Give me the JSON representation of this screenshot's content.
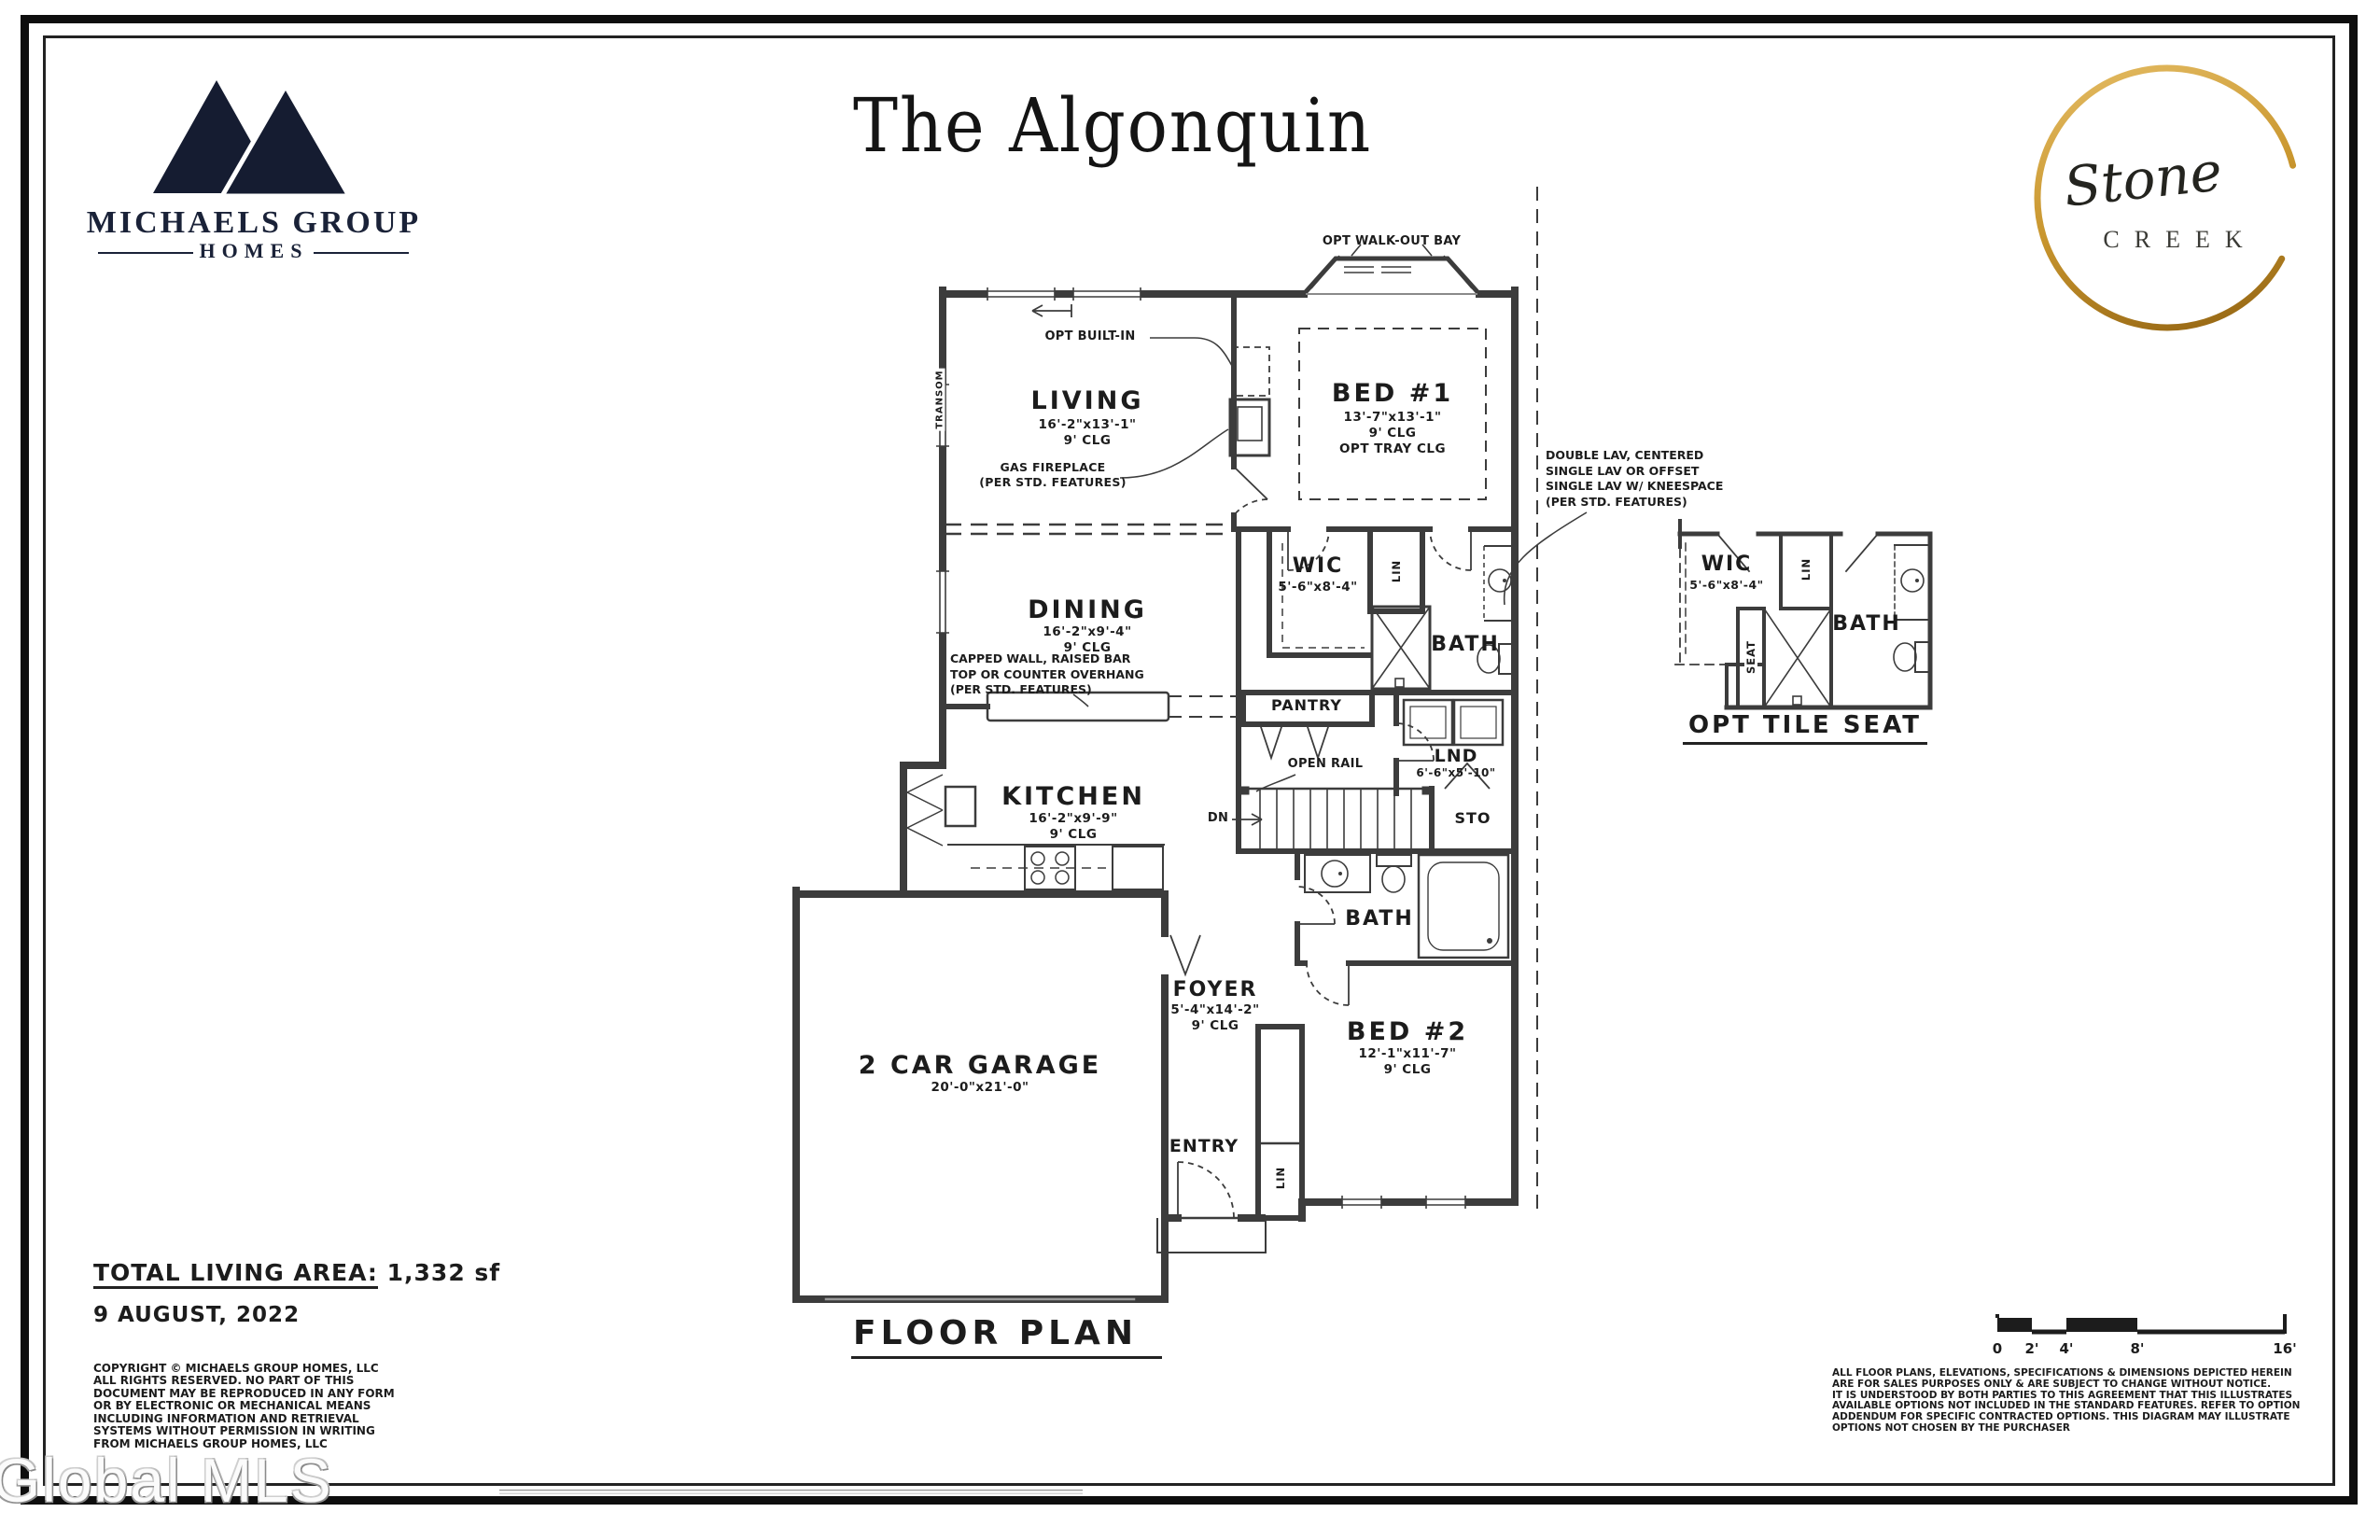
{
  "header": {
    "builder_logo": {
      "line1": "MICHAELS GROUP",
      "line2": "HOMES"
    },
    "plan_title": "The Algonquin",
    "community_logo": {
      "script": "Stone",
      "caps": "CREEK"
    }
  },
  "plan": {
    "rooms": {
      "living": {
        "name": "LIVING",
        "dims": "16'-2\"x13'-1\"",
        "clg": "9' CLG"
      },
      "bed1": {
        "name": "BED #1",
        "dims": "13'-7\"x13'-1\"",
        "clg": "9' CLG",
        "opt": "OPT TRAY CLG"
      },
      "dining": {
        "name": "DINING",
        "dims": "16'-2\"x9'-4\"",
        "clg": "9' CLG"
      },
      "kitchen": {
        "name": "KITCHEN",
        "dims": "16'-2\"x9'-9\"",
        "clg": "9' CLG"
      },
      "garage": {
        "name": "2 CAR GARAGE",
        "dims": "20'-0\"x21'-0\""
      },
      "foyer": {
        "name": "FOYER",
        "dims": "5'-4\"x14'-2\"",
        "clg": "9' CLG"
      },
      "bed2": {
        "name": "BED #2",
        "dims": "12'-1\"x11'-7\"",
        "clg": "9' CLG"
      },
      "wic": {
        "name": "WIC",
        "dims": "5'-6\"x8'-4\""
      },
      "bath1": {
        "name": "BATH"
      },
      "bath2": {
        "name": "BATH"
      },
      "laundry": {
        "name": "LND",
        "dims": "6'-6\"x5'-10\""
      },
      "pantry": {
        "name": "PANTRY"
      },
      "storage": {
        "name": "STO"
      },
      "entry": {
        "name": "ENTRY"
      },
      "linen1": "LIN",
      "linen2": "LIN",
      "down": "DN"
    },
    "notes": {
      "walkout_bay": "OPT WALK-OUT BAY",
      "built_in": "OPT BUILT-IN",
      "transom": "TRANSOM",
      "fireplace": [
        "GAS FIREPLACE",
        "(PER STD. FEATURES)"
      ],
      "capped_wall": [
        "CAPPED WALL, RAISED BAR",
        "TOP OR COUNTER OVERHANG",
        "(PER STD. FEATURES)"
      ],
      "double_lav": [
        "DOUBLE LAV, CENTERED",
        "SINGLE LAV OR OFFSET",
        "SINGLE LAV W/ KNEESPACE",
        "(PER STD. FEATURES)"
      ],
      "open_rail": "OPEN RAIL"
    },
    "detail": {
      "wic": {
        "name": "WIC",
        "dims": "5'-6\"x8'-4\""
      },
      "linen": "LIN",
      "seat": "SEAT",
      "bath": "BATH",
      "caption": "OPT TILE SEAT"
    }
  },
  "footer": {
    "area_label": "TOTAL LIVING AREA:",
    "area_value": "1,332 sf",
    "date": "9 AUGUST, 2022",
    "drawing_label": "FLOOR PLAN",
    "copyright": [
      "COPYRIGHT © MICHAELS GROUP HOMES, LLC",
      "ALL RIGHTS RESERVED. NO PART OF THIS",
      "DOCUMENT MAY BE REPRODUCED IN ANY FORM",
      "OR BY ELECTRONIC OR MECHANICAL MEANS",
      "INCLUDING INFORMATION AND RETRIEVAL",
      "SYSTEMS WITHOUT PERMISSION IN WRITING",
      "FROM MICHAELS GROUP HOMES, LLC"
    ],
    "disclaimer": [
      "ALL FLOOR PLANS, ELEVATIONS, SPECIFICATIONS & DIMENSIONS DEPICTED HEREIN",
      "ARE FOR SALES PURPOSES ONLY & ARE SUBJECT TO CHANGE WITHOUT NOTICE.",
      "IT IS UNDERSTOOD BY BOTH PARTIES TO THIS AGREEMENT THAT THIS ILLUSTRATES",
      "AVAILABLE OPTIONS NOT INCLUDED IN THE STANDARD FEATURES. REFER TO OPTION",
      "ADDENDUM FOR SPECIFIC CONTRACTED OPTIONS. THIS DIAGRAM MAY ILLUSTRATE",
      "OPTIONS NOT CHOSEN BY THE PURCHASER"
    ],
    "scale_labels": [
      "0",
      "2'",
      "4'",
      "8'",
      "16'"
    ]
  },
  "watermark": "Global MLS",
  "colors": {
    "wall": "#3c3c3c",
    "ink": "#1c1c1c",
    "navy": "#1a2238",
    "gold": "#c9962e"
  }
}
